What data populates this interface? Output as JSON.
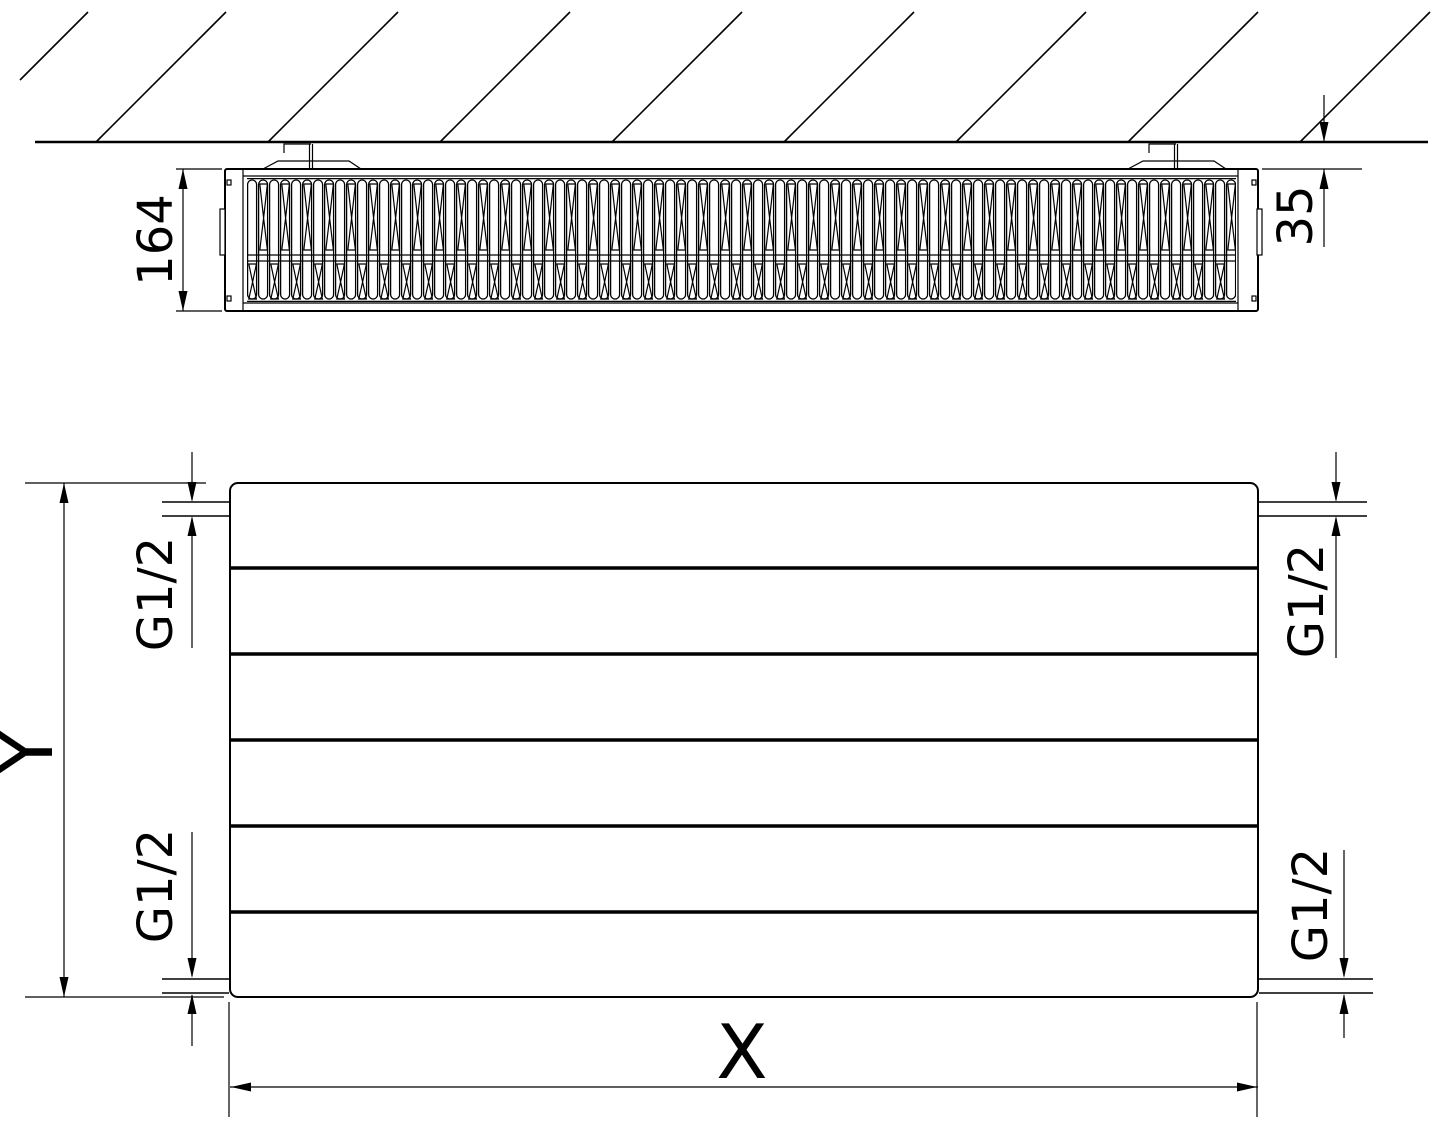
{
  "labels": {
    "side_height": "164",
    "wall_gap": "35",
    "front_height": "Y",
    "front_width": "X",
    "conn_top_left": "G1/2",
    "conn_top_right": "G1/2",
    "conn_bottom_left": "G1/2",
    "conn_bottom_right": "G1/2"
  },
  "colors": {
    "line": "#000000",
    "background": "#ffffff"
  }
}
